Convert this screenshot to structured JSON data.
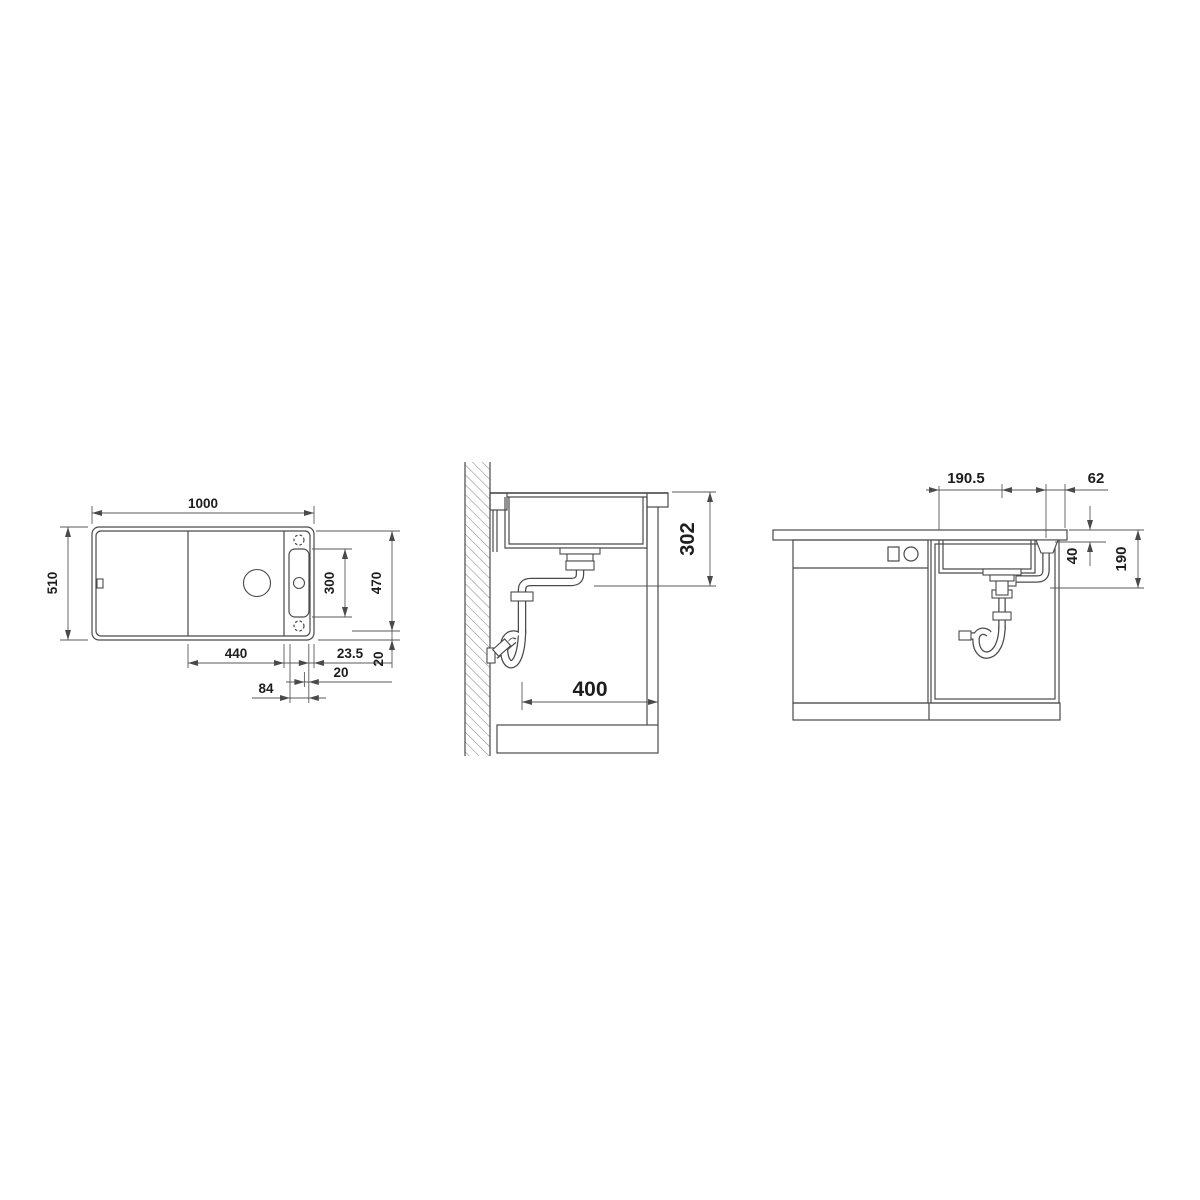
{
  "drawing": {
    "type": "sink-installation-drawing",
    "background": "#ffffff",
    "line_color": "#4a4a4a",
    "text_color": "#1d1d1d"
  },
  "views": {
    "top_view": {
      "dims": {
        "overall_width": "1000",
        "overall_depth": "510",
        "tap_ledge_length": "300",
        "basin_zone_depth": "470",
        "bowl_width": "440",
        "rim_to_edge": "23.5",
        "ledge_offset": "20",
        "depth_margin": "20",
        "ledge_width": "84"
      }
    },
    "side_view": {
      "dims": {
        "outlet_height": "302",
        "outlet_clearance": "400"
      }
    },
    "front_view": {
      "dims": {
        "bowl_edge_to_drain": "190.5",
        "outlet_to_edge": "62",
        "under_counter": "40",
        "outlet_drop": "190"
      }
    }
  }
}
